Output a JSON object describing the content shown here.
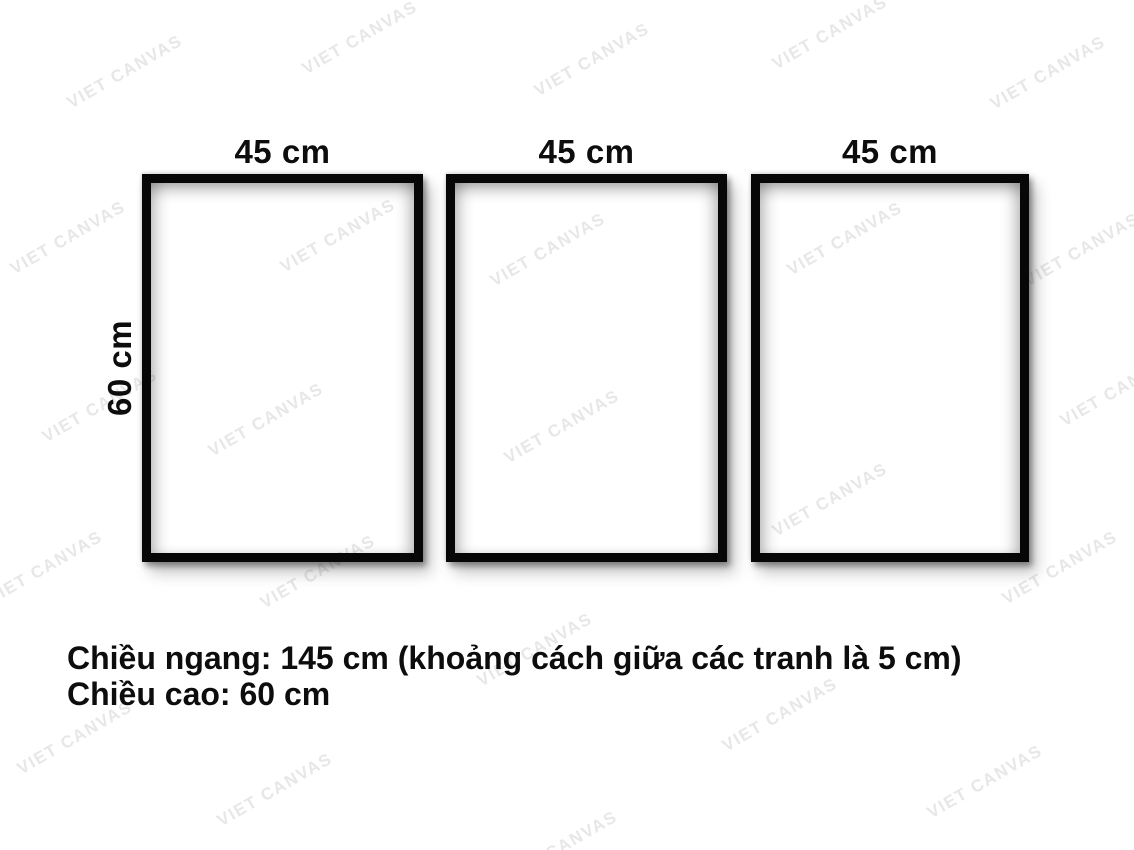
{
  "page": {
    "width_px": 1134,
    "height_px": 850,
    "background_color": "#ffffff"
  },
  "frames": [
    {
      "label": "45 cm"
    },
    {
      "label": "45 cm"
    },
    {
      "label": "45 cm"
    }
  ],
  "height_label": "60 cm",
  "caption": {
    "line1": "Chiều ngang: 145 cm (khoảng cách giữa các tranh là 5 cm)",
    "line2": "Chiều cao: 60 cm"
  },
  "watermark": {
    "text": "VIET CANVAS",
    "color": "#e7e7e7",
    "rotation_deg": -30,
    "positions": [
      [
        125,
        72
      ],
      [
        360,
        38
      ],
      [
        592,
        60
      ],
      [
        830,
        33
      ],
      [
        1048,
        73
      ],
      [
        68,
        238
      ],
      [
        338,
        236
      ],
      [
        548,
        250
      ],
      [
        845,
        239
      ],
      [
        1082,
        250
      ],
      [
        100,
        406
      ],
      [
        266,
        420
      ],
      [
        562,
        427
      ],
      [
        830,
        500
      ],
      [
        1118,
        390
      ],
      [
        45,
        568
      ],
      [
        318,
        572
      ],
      [
        1060,
        568
      ],
      [
        535,
        650
      ],
      [
        780,
        715
      ],
      [
        75,
        738
      ],
      [
        275,
        790
      ],
      [
        985,
        782
      ],
      [
        560,
        848
      ]
    ]
  },
  "colors": {
    "frame_border": "#070707",
    "text": "#0d0d0d"
  }
}
